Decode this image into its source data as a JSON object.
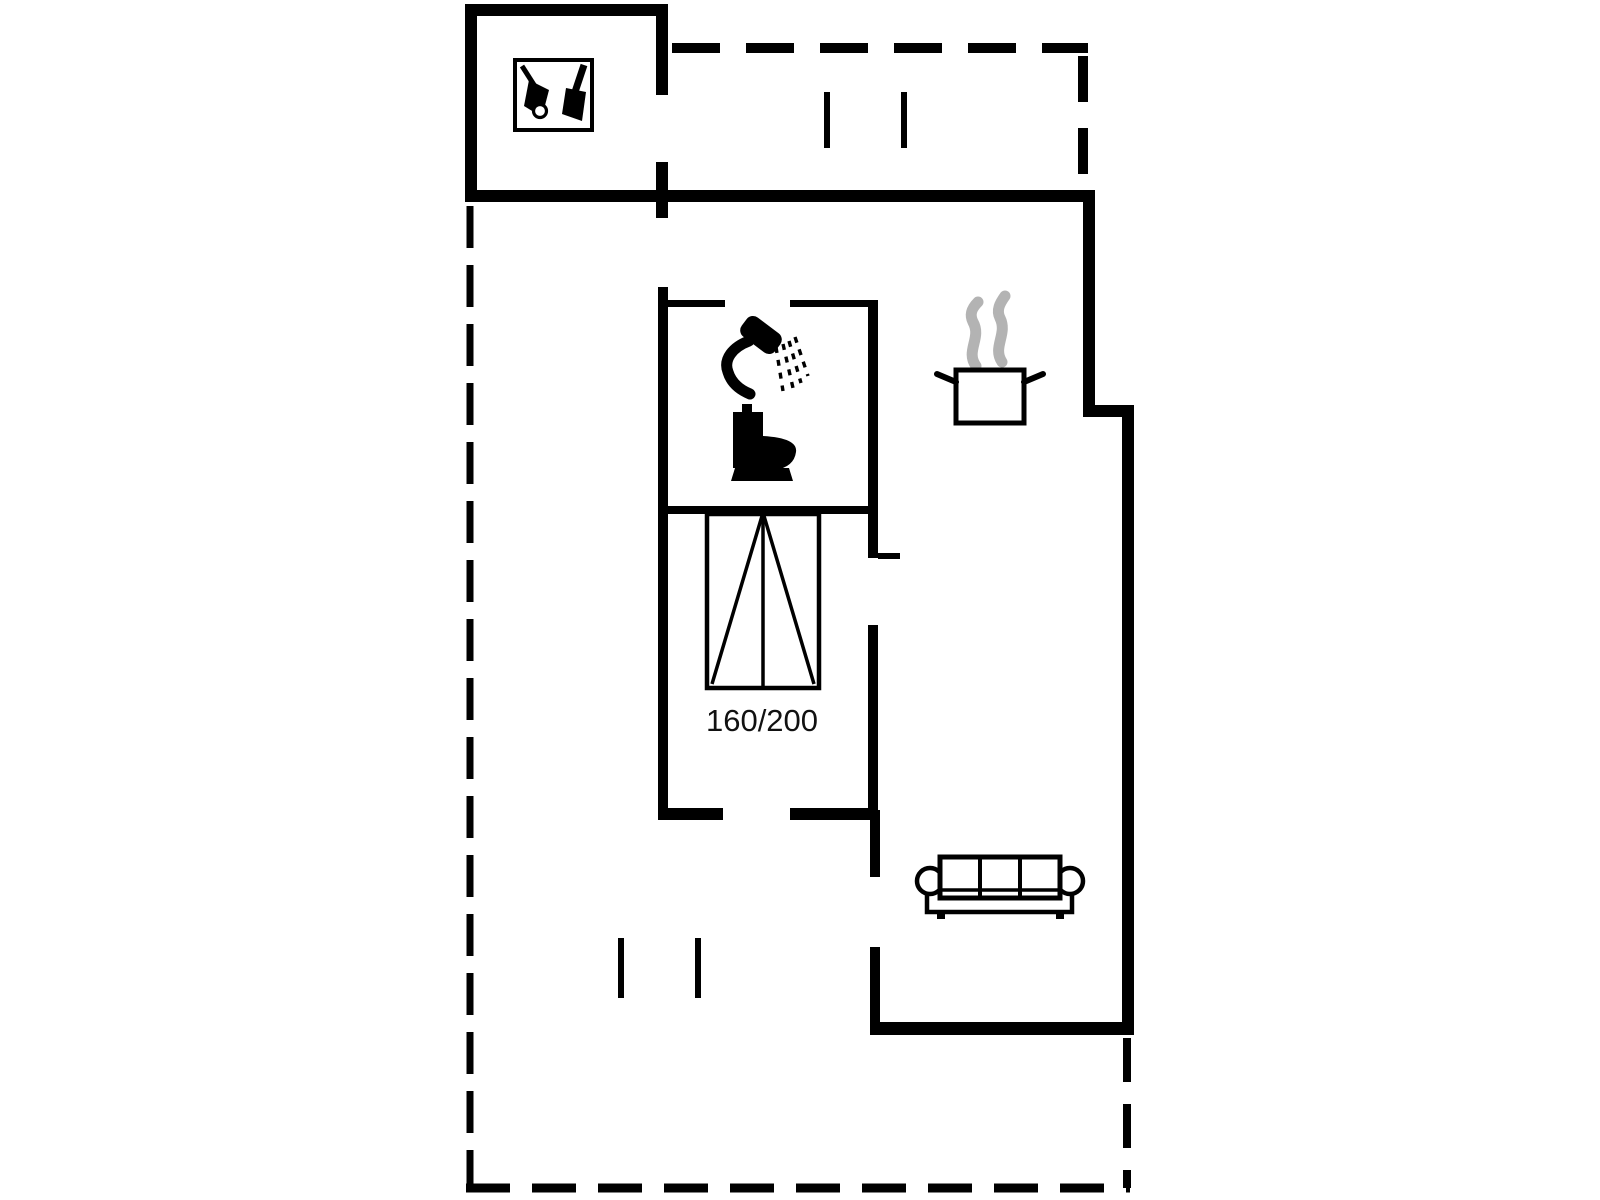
{
  "floor_plan": {
    "bed": {
      "size_label": "160/200"
    },
    "colors": {
      "background": "#ffffff",
      "walls": "#000000",
      "furniture_outline": "#000000",
      "steam": "#b3b3b3"
    },
    "icons": [
      "garden-tools-icon",
      "shower-icon",
      "toilet-icon",
      "cooking-pot-icon",
      "sofa-icon",
      "double-bed-icon"
    ],
    "line_styles": {
      "solid": "walls",
      "dashed": "terrace-roof-outline"
    }
  }
}
